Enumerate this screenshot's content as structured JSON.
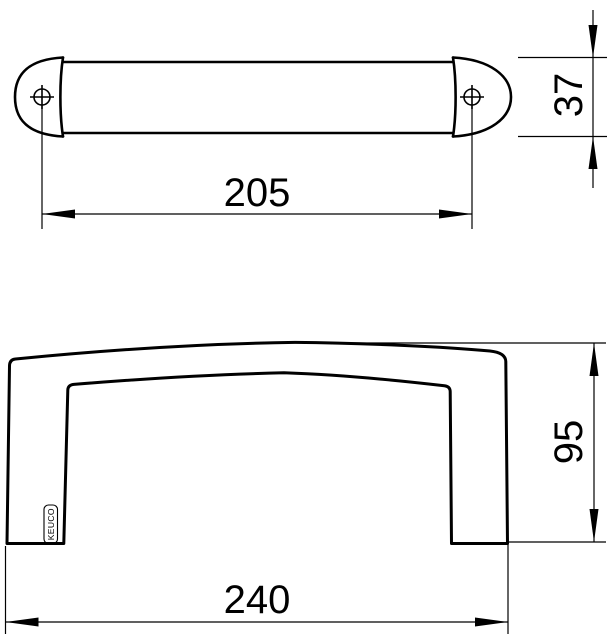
{
  "drawing": {
    "title": "handle technical drawing",
    "colors": {
      "line": "#000000",
      "background": "#ffffff"
    },
    "logo": "KEUCO",
    "dimensions": {
      "top_width": "205",
      "top_height": "37",
      "front_width": "240",
      "front_height": "95"
    }
  }
}
